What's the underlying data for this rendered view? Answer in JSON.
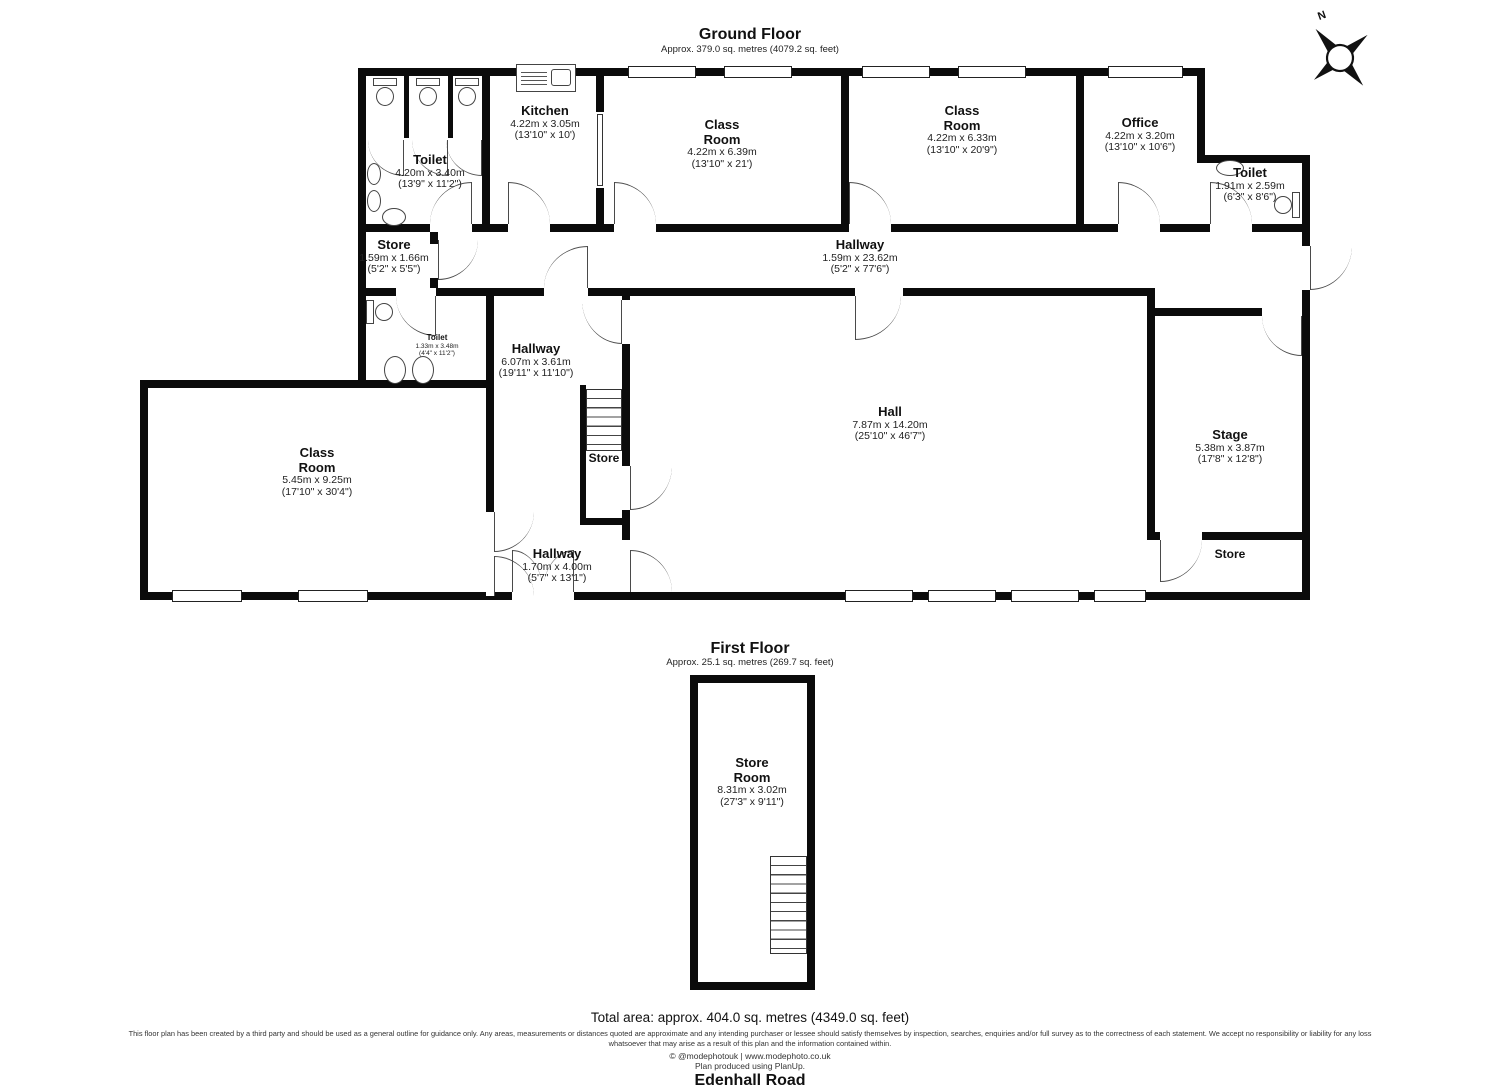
{
  "ground_floor": {
    "title": "Ground Floor",
    "subtitle": "Approx. 379.0 sq. metres (4079.2 sq. feet)"
  },
  "first_floor": {
    "title": "First Floor",
    "subtitle": "Approx. 25.1 sq. metres (269.7 sq. feet)"
  },
  "compass": {
    "north_label": "N"
  },
  "rooms": [
    {
      "name": "Toilet",
      "metric": "4.20m x 3.40m",
      "imperial": "(13'9\" x 11'2\")"
    },
    {
      "name": "Kitchen",
      "metric": "4.22m x 3.05m",
      "imperial": "(13'10\" x 10')"
    },
    {
      "name": "Class Room",
      "metric": "4.22m x 6.39m",
      "imperial": "(13'10\" x 21')"
    },
    {
      "name": "Class Room",
      "metric": "4.22m x 6.33m",
      "imperial": "(13'10\" x 20'9\")"
    },
    {
      "name": "Office",
      "metric": "4.22m x 3.20m",
      "imperial": "(13'10\" x 10'6\")"
    },
    {
      "name": "Toilet",
      "metric": "1.91m x 2.59m",
      "imperial": "(6'3\" x 8'6\")"
    },
    {
      "name": "Store",
      "metric": "1.59m x 1.66m",
      "imperial": "(5'2\" x 5'5\")"
    },
    {
      "name": "Hallway",
      "metric": "1.59m x 23.62m",
      "imperial": "(5'2\" x 77'6\")"
    },
    {
      "name": "Toilet",
      "metric": "1.33m x 3.48m",
      "imperial": "(4'4\" x 11'2\")"
    },
    {
      "name": "Hallway",
      "metric": "6.07m x 3.61m",
      "imperial": "(19'11\" x 11'10\")"
    },
    {
      "name": "Class Room",
      "metric": "5.45m x 9.25m",
      "imperial": "(17'10\" x 30'4\")"
    },
    {
      "name": "Hall",
      "metric": "7.87m x 14.20m",
      "imperial": "(25'10\" x 46'7\")"
    },
    {
      "name": "Stage",
      "metric": "5.38m x 3.87m",
      "imperial": "(17'8\" x 12'8\")"
    },
    {
      "name": "Store"
    },
    {
      "name": "Store"
    },
    {
      "name": "Hallway",
      "metric": "1.70m x 4.00m",
      "imperial": "(5'7\" x 13'1\")"
    },
    {
      "name": "Store Room",
      "metric": "8.31m x 3.02m",
      "imperial": "(27'3\" x 9'11\")"
    }
  ],
  "footer": {
    "total_area": "Total area: approx. 404.0 sq. metres (4349.0 sq. feet)",
    "disclaimer": "This floor plan has been created by a third party and should be used as a general outline for guidance only. Any areas, measurements or distances quoted are approximate and any intending purchaser or lessee should satisfy themselves by inspection, searches, enquiries and/or full survey as to the correctness of each statement. We accept no responsibility or liability for any loss whatsoever that may arise as a result of this plan and the information contained within.",
    "credit": "© @modephotouk | www.modephoto.co.uk",
    "software": "Plan produced using PlanUp.",
    "street": "Edenhall Road"
  }
}
